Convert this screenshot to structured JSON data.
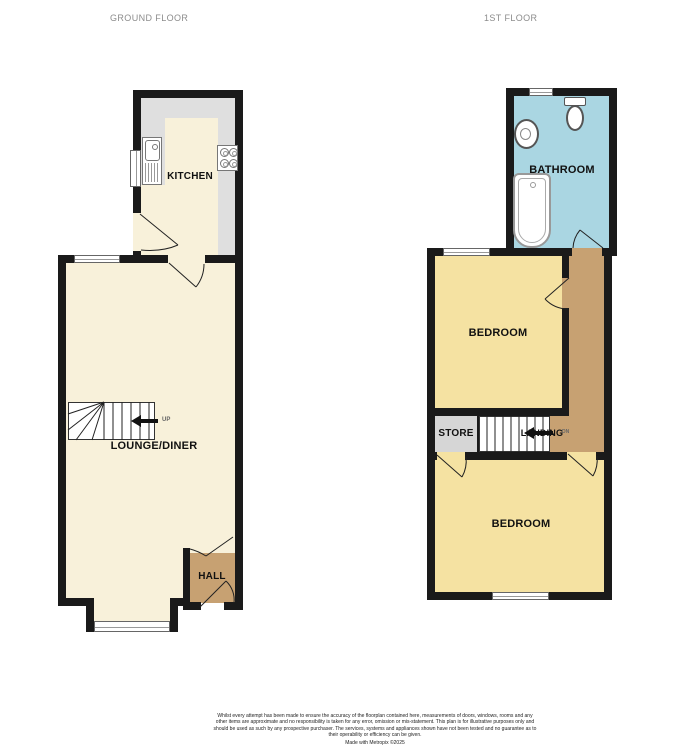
{
  "colors": {
    "wall": "#1a1a1a",
    "cream": "#f8f1da",
    "counter": "#dfdfdf",
    "yellow": "#f5e2a2",
    "blue": "#aad6e2",
    "tan": "#c7a172",
    "store": "#d6d6d6",
    "titlegrey": "#8c8c8c"
  },
  "titles": {
    "ground": "GROUND FLOOR",
    "first": "1ST FLOOR"
  },
  "ground_floor": {
    "kitchen_label": "KITCHEN",
    "lounge_label": "LOUNGE/DINER",
    "hall_label": "HALL",
    "stairs_label": "UP"
  },
  "first_floor": {
    "bathroom_label": "BATHROOM",
    "bedroom_front_label": "BEDROOM",
    "bedroom_back_label": "BEDROOM",
    "store_label": "STORE",
    "landing_label": "LANDING",
    "stairs_label": "DN"
  },
  "icons": {
    "kitchen_sink": "sink-icon",
    "kitchen_hob": "hob-icon",
    "toilet": "toilet-icon",
    "wash_basin": "basin-icon",
    "bathtub": "bathtub-icon",
    "stairs_up_arrow": "arrow-left-icon",
    "stairs_down_arrow": "arrow-left-icon"
  },
  "footer": {
    "disclaimer": "Whilst every attempt has been made to ensure the accuracy of the floorplan contained here, measurements of doors, windows, rooms and any other items are approximate and no responsibility is taken for any error, omission or mis-statement. This plan is for illustrative purposes only and should be used as such by any prospective purchaser. The services, systems and appliances shown have not been tested and no guarantee as to their operability or efficiency can be given.",
    "credit": "Made with Metropix ©2025"
  }
}
